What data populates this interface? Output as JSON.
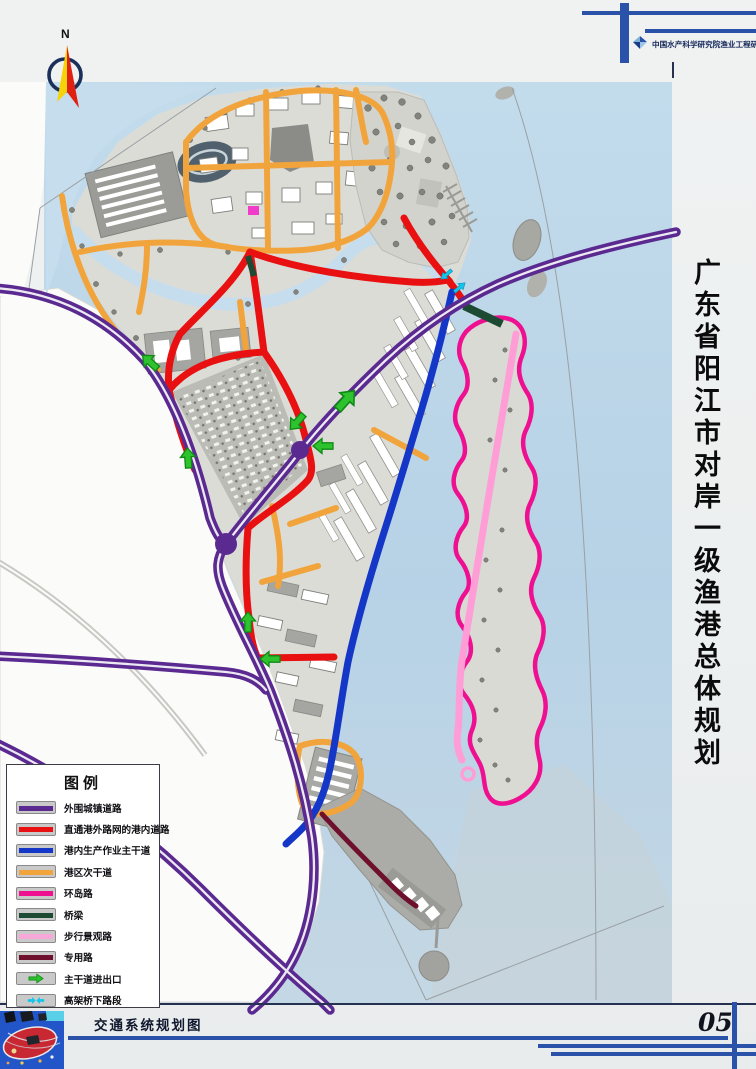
{
  "header": {
    "institute": "中国水产科学研究院渔业工程研究所"
  },
  "compass": {
    "label": "N"
  },
  "side_title": {
    "text": "广东省阳江市对岸一级渔港总体规划"
  },
  "legend": {
    "title": "图例",
    "items": [
      {
        "label": "外围城镇道路",
        "color": "#5b2a91",
        "type": "line"
      },
      {
        "label": "直通港外路网的港内道路",
        "color": "#e81010",
        "type": "line"
      },
      {
        "label": "港内生产作业主干道",
        "color": "#1437c8",
        "type": "line"
      },
      {
        "label": "港区次干道",
        "color": "#f2a43c",
        "type": "line"
      },
      {
        "label": "环岛路",
        "color": "#ee1090",
        "type": "line"
      },
      {
        "label": "桥梁",
        "color": "#1d4a33",
        "type": "line"
      },
      {
        "label": "步行景观路",
        "color": "#f8a8d8",
        "type": "line"
      },
      {
        "label": "专用路",
        "color": "#6d0f2d",
        "type": "line"
      },
      {
        "label": "主干道进出口",
        "color": "#2ec22e",
        "type": "arrow"
      },
      {
        "label": "高架桥下路段",
        "color": "#14c6ea",
        "type": "double-arrow"
      }
    ]
  },
  "footer": {
    "title": "交通系统规划图",
    "page_number": "05"
  },
  "map_colors": {
    "sea": "#bcd6e8",
    "bay": "#c6ddee",
    "planned_land": "#dcdcd7",
    "open_land": "#fbfbfa",
    "island": "#dadad4"
  }
}
